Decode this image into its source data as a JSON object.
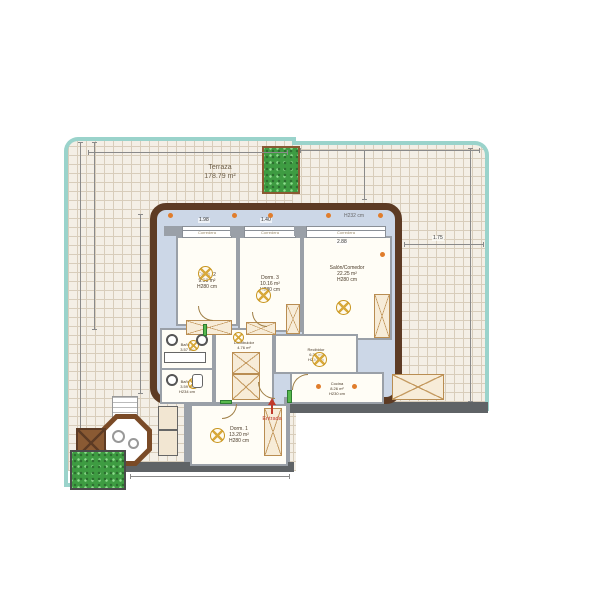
{
  "plan": {
    "terrace": {
      "label": "Terraza",
      "area": "178.79 m²"
    },
    "rooms": {
      "dorm2": {
        "name": "Dorm. 2",
        "area": "9.98 m²",
        "height": "H280 cm"
      },
      "dorm3": {
        "name": "Dorm. 3",
        "area": "10.16 m²",
        "height": "H280 cm"
      },
      "salon": {
        "name": "Salón/Comedor",
        "area": "22.25 m²",
        "height": "H280 cm"
      },
      "banyo2": {
        "name": "Baño 2",
        "area": "3.57 m²",
        "height": "H234 cm"
      },
      "banyo1": {
        "name": "Baño 1",
        "area": "3.59 m²",
        "height": "H234 cm"
      },
      "distribuidor": {
        "name": "Distribuidor",
        "area": "4.76 m²",
        "height": ""
      },
      "recibidor": {
        "name": "Recibidor",
        "area": "6.36 m²",
        "height": "H230 cm"
      },
      "cocina": {
        "name": "Cocina",
        "area": "8.26 m²",
        "height": "H230 cm"
      },
      "dorm1": {
        "name": "Dorm. 1",
        "area": "13.20 m²",
        "height": "H280 cm"
      }
    },
    "annotations": {
      "entrance": "Entrada",
      "ceiling_height": "H232 cm",
      "window_type": "Corredera"
    },
    "dimensions": {
      "win1": "1.98",
      "win2": "1.40",
      "win3": "2.88",
      "right": "1.75",
      "bottom": "2.46"
    },
    "colors": {
      "tile": "#f4efe6",
      "grout": "#d8cdbb",
      "railing": "#9ad3cb",
      "wall_brown": "#5d3b24",
      "interior_blue": "#ccd7e7",
      "partition_grey": "#9aa0a8",
      "furniture_beige": "#f7ecd8",
      "light_orange": "#c8951f",
      "downlight_orange": "#e07d2c",
      "plant_green": "#3e9c42",
      "entrance_red": "#c0392b"
    }
  }
}
